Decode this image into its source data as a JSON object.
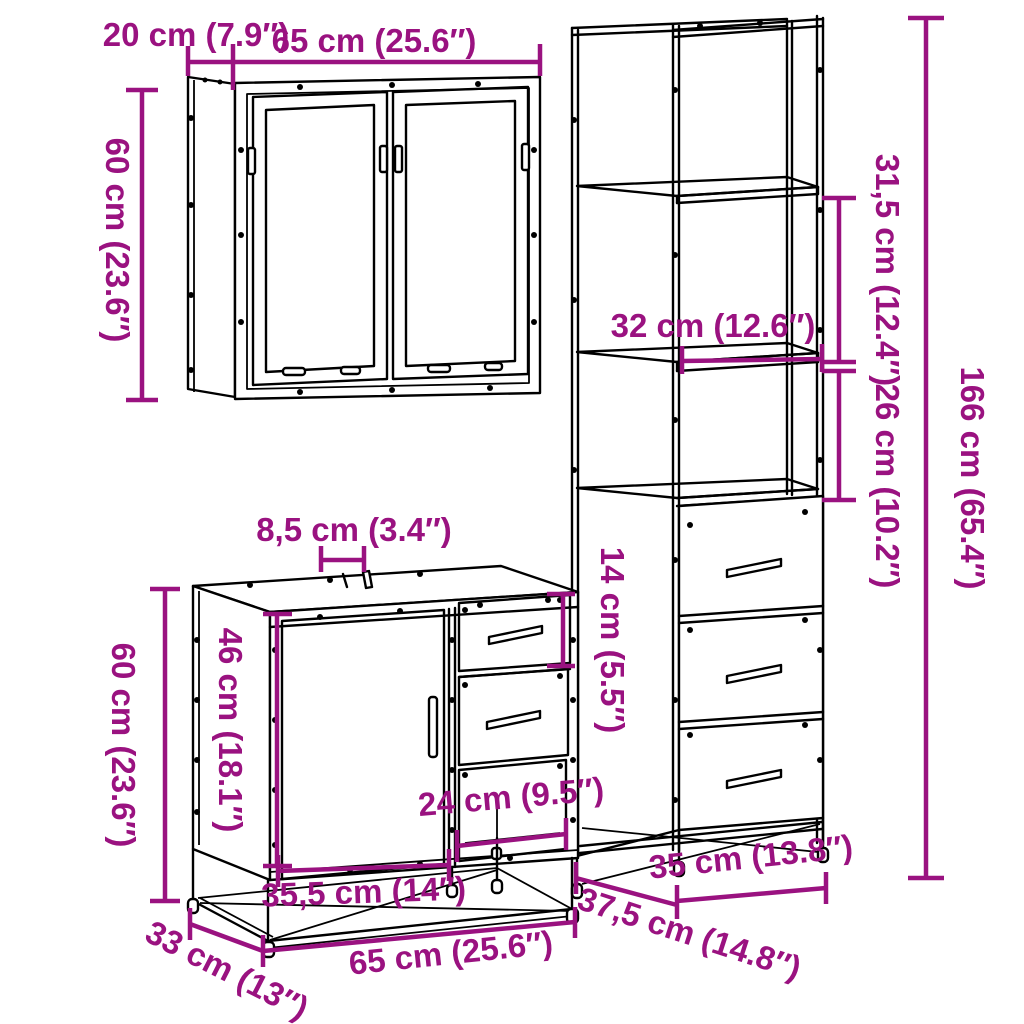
{
  "diagram": {
    "type": "furniture-dimension-diagram",
    "accent_color": "#9A1280",
    "line_color": "#000000",
    "background_color": "#FFFFFF",
    "pieces": [
      "wall cabinet with two mirror doors",
      "tall cabinet with open shelves and three drawers",
      "sink cabinet with door, two drawers and open bay"
    ],
    "measurements": {
      "mirror_depth": "20 cm (7.9″)",
      "mirror_width": "65 cm (25.6″)",
      "mirror_height": "60 cm (23.6″)",
      "tall_upper_gap": "31,5 cm (12.4″)",
      "tall_height": "166 cm (65.4″)",
      "tall_shelf_width": "32 cm (12.6″)",
      "tall_lower_gap": "26 cm (10.2″)",
      "vanity_top_gap": "8,5 cm (3.4″)",
      "vanity_drawer_height": "14 cm (5.5″)",
      "vanity_inner_height": "46 cm (18.1″)",
      "vanity_height": "60 cm (23.6″)",
      "vanity_bay_width": "24 cm (9.5″)",
      "vanity_door_width": "35,5 cm (14″)",
      "vanity_width": "65 cm (25.6″)",
      "vanity_depth": "33 cm (13″)",
      "tall_width": "35 cm (13.8″)",
      "tall_depth": "37,5 cm (14.8″)"
    }
  }
}
